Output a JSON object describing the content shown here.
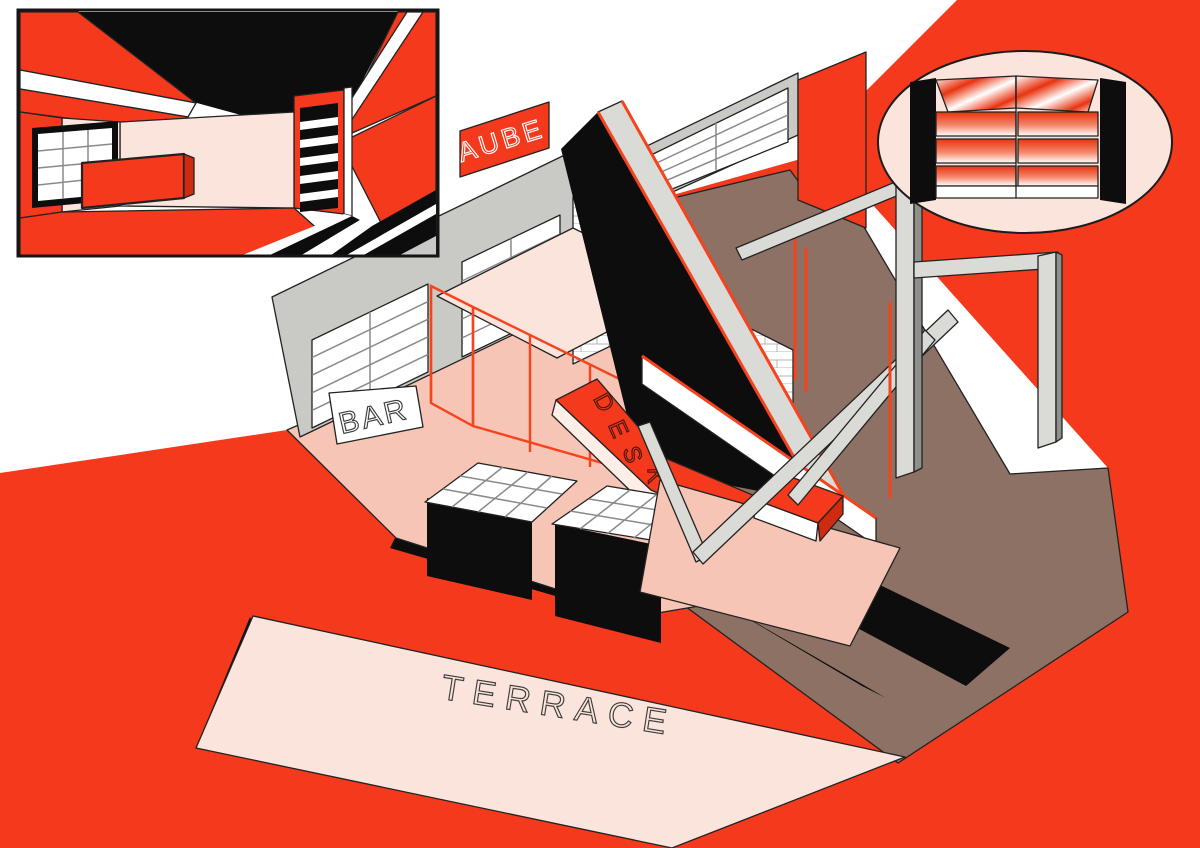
{
  "labels": {
    "sign": "AUBE",
    "bar": "BAR",
    "desk": "DESK",
    "desk_letters": [
      "D",
      "E",
      "S",
      "K"
    ],
    "terrace": "TERRACE"
  },
  "colors": {
    "red": "#f4391d",
    "dark_red": "#cf2b10",
    "floor_pink": "#f7c5b6",
    "pale_pink": "#fbe4dc",
    "brown": "#8d7164",
    "wall_gray": "#c9c9c5",
    "beam_gray": "#dadad6",
    "gray_dark": "#8f8f8b",
    "black": "#0d0d0d",
    "white": "#ffffff",
    "outline": "#222222",
    "brick_line": "#b5b5b2",
    "window_line": "#8a8a88",
    "mesh_red": "#f4431d",
    "text_dark": "#3c3c3c",
    "desk_text": "#4a1607"
  }
}
